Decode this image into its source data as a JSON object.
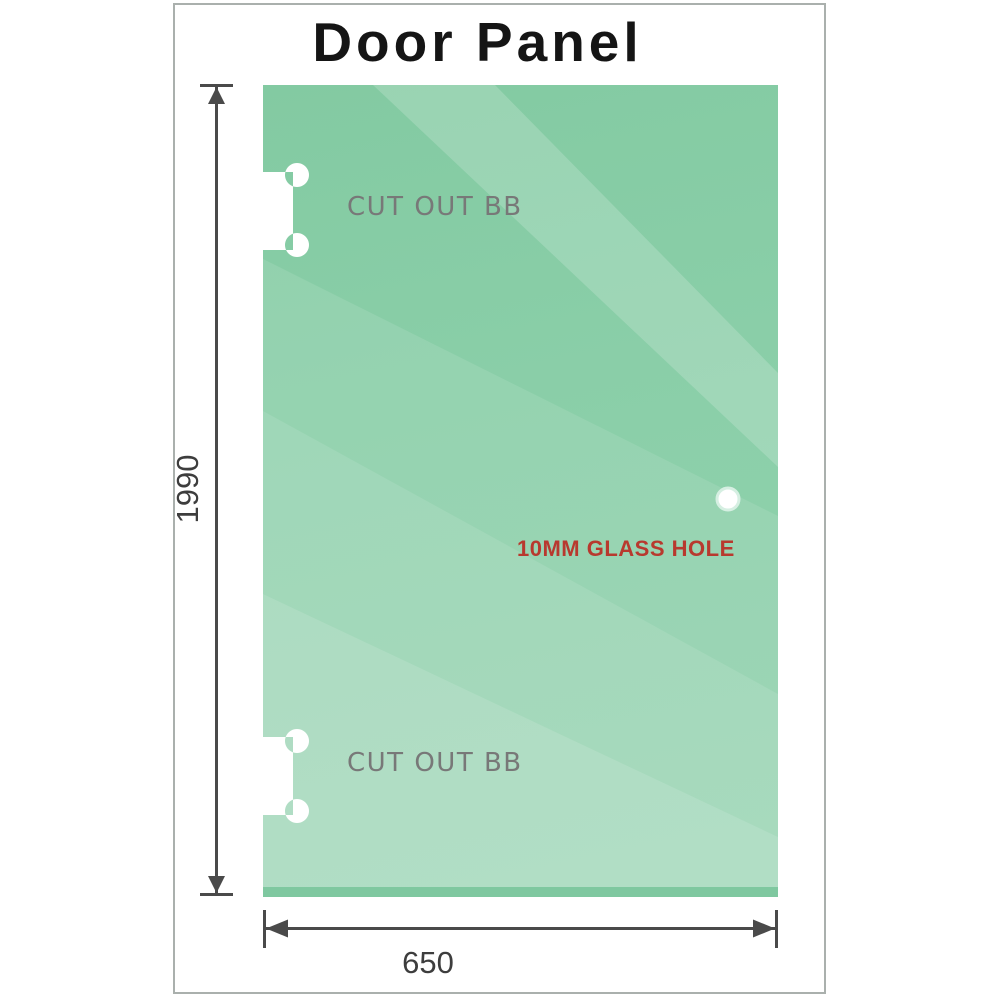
{
  "title": "Door Panel",
  "panel": {
    "cutout_top_label": "CUT OUT BB",
    "cutout_bottom_label": "CUT OUT BB",
    "hole_label": "10MM GLASS HOLE"
  },
  "dimensions": {
    "height_label": "1990",
    "width_label": "650"
  },
  "colors": {
    "glass_base_green": "#85cba4",
    "glass_highlight_green": "#c2e6d1",
    "glass_bottom_edge_green": "#7fc8a0",
    "dimension_line_gray": "#4a4a4a",
    "frame_border_gray": "#aab0ad",
    "cutout_label_gray": "#787878",
    "hole_label_red": "#b8392e",
    "title_black": "#151515"
  }
}
